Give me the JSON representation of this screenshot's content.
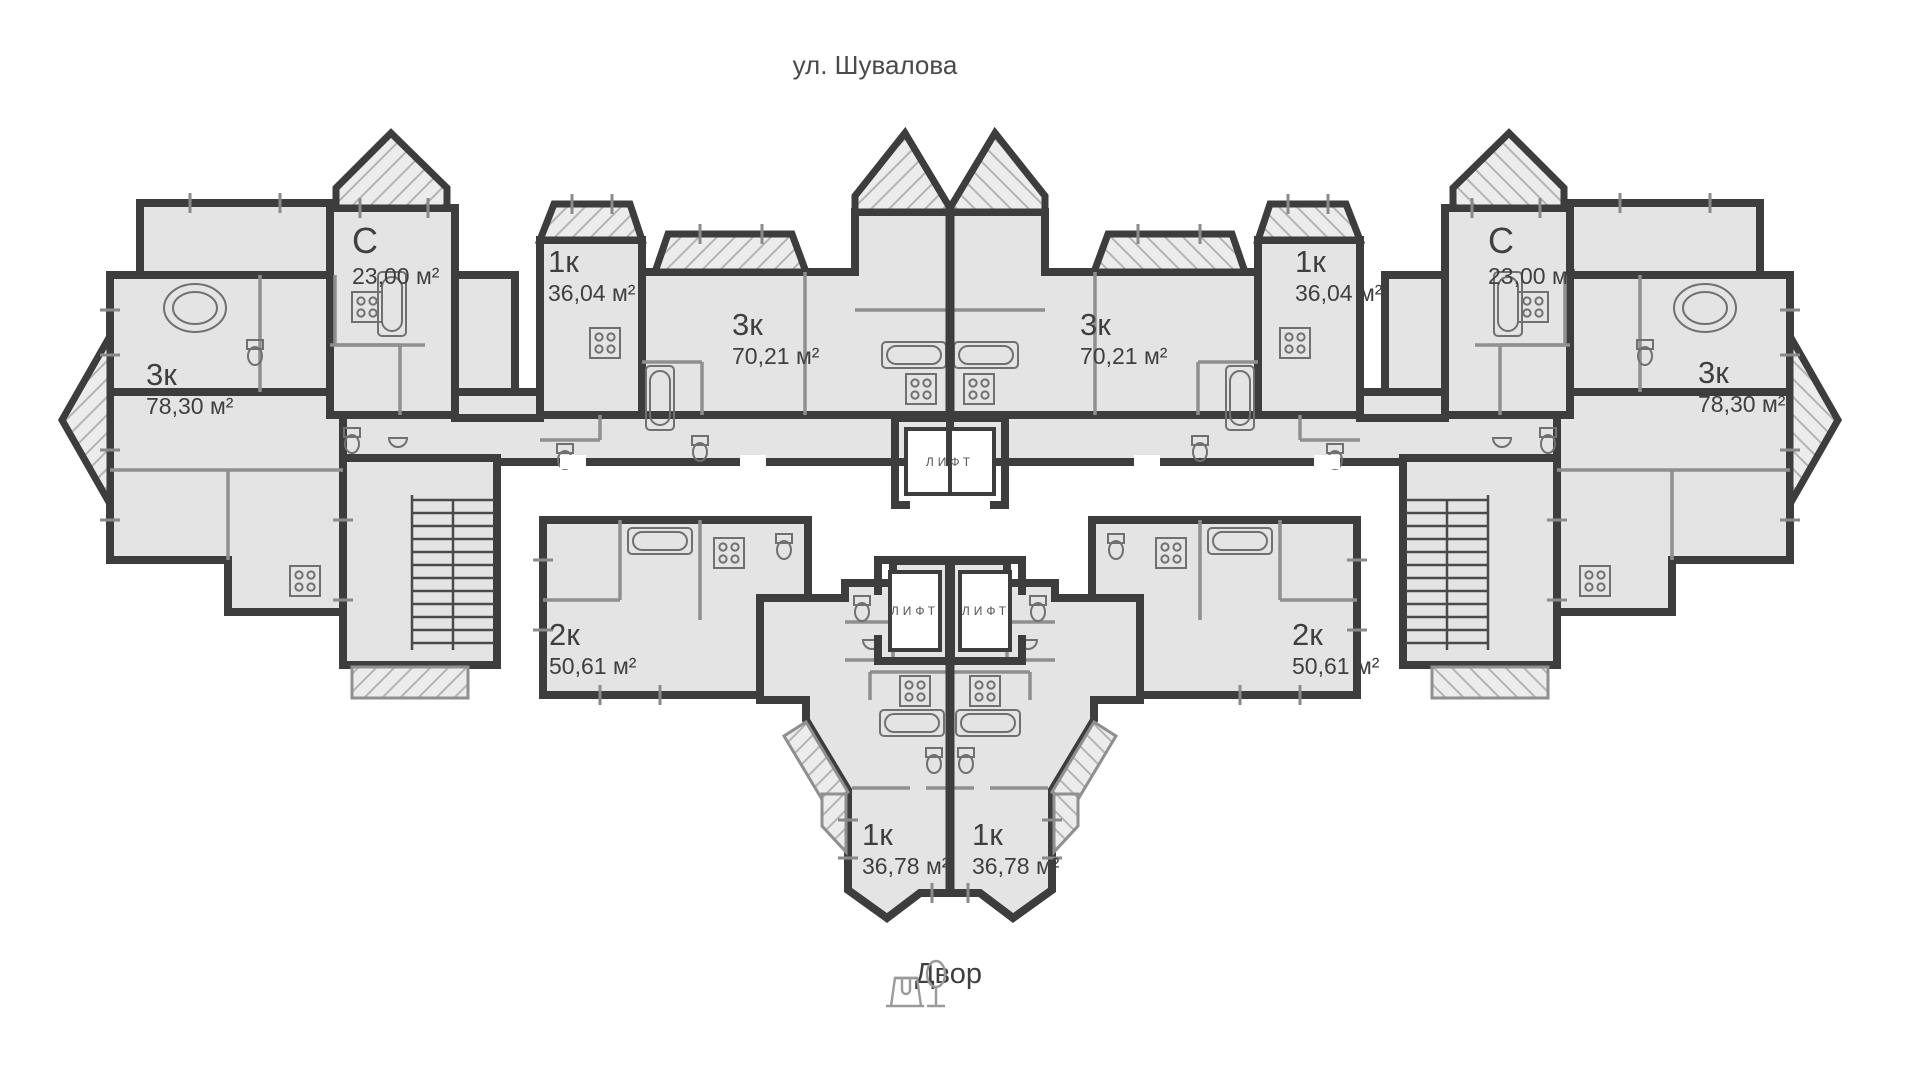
{
  "street": {
    "label": "ул. Шувалова"
  },
  "courtyard": {
    "label": "Двор",
    "icon": "swing-and-tree-icon"
  },
  "elevator": {
    "label": "ЛИФТ",
    "count": 3
  },
  "apartments": [
    {
      "id": "left-3k-78",
      "type": "3к",
      "area": "78,30 м²"
    },
    {
      "id": "left-studio",
      "type": "С",
      "area": "23,00 м²"
    },
    {
      "id": "left-1k-36",
      "type": "1к",
      "area": "36,04 м²"
    },
    {
      "id": "left-3k-70",
      "type": "3к",
      "area": "70,21 м²"
    },
    {
      "id": "right-3k-70",
      "type": "3к",
      "area": "70,21 м²"
    },
    {
      "id": "right-1k-36",
      "type": "1к",
      "area": "36,04 м²"
    },
    {
      "id": "right-studio",
      "type": "С",
      "area": "23,00 м²"
    },
    {
      "id": "right-3k-78",
      "type": "3к",
      "area": "78,30 м²"
    },
    {
      "id": "left-2k-50",
      "type": "2к",
      "area": "50,61 м²"
    },
    {
      "id": "right-2k-50",
      "type": "2к",
      "area": "50,61 м²"
    },
    {
      "id": "bottom-left-1k",
      "type": "1к",
      "area": "36,78 м²"
    },
    {
      "id": "bottom-right-1k",
      "type": "1к",
      "area": "36,78 м²"
    }
  ],
  "colors": {
    "floor_fill": "#e4e4e4",
    "outer_wall": "#3d3d3d",
    "partition": "#8f8f8f",
    "text": "#3f3f3f",
    "background": "#ffffff"
  }
}
